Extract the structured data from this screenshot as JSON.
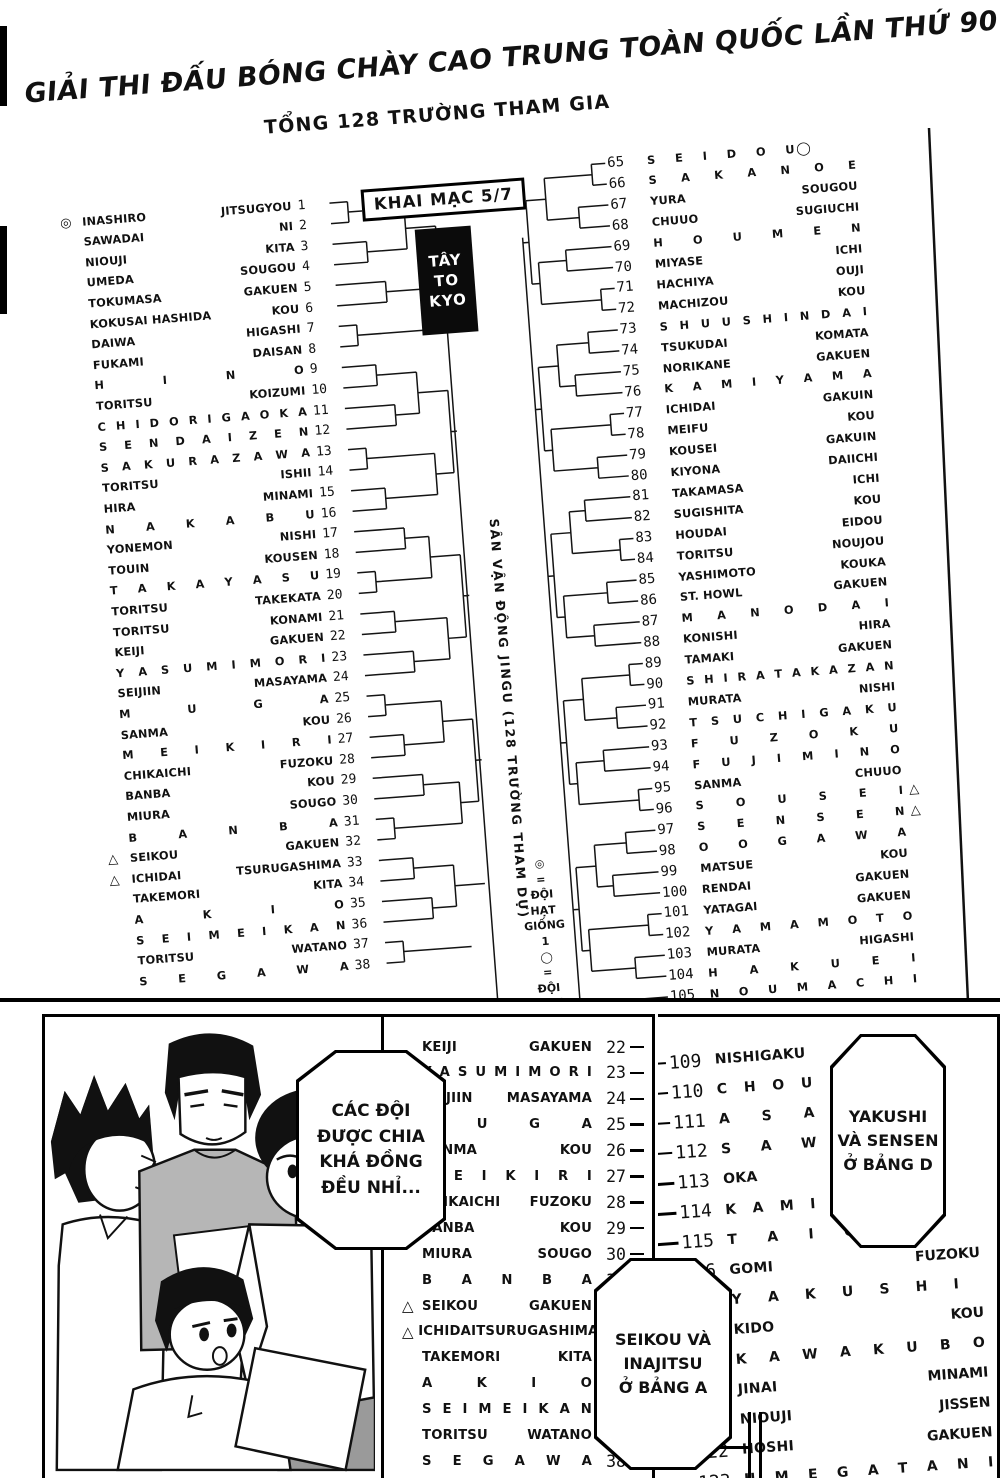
{
  "header": {
    "title_line1": "GIẢI THI ĐẤU BÓNG CHÀY CAO TRUNG TOÀN QUỐC LẦN THỨ 90",
    "title_line2": "TỔNG 128 TRƯỜNG THAM GIA",
    "opening_label": "KHAI MẠC 5/7",
    "region_box_lines": [
      "TÂY",
      "TO",
      "KYO"
    ]
  },
  "center": {
    "venue_vertical_text": "SÂN VẬN ĐỘNG JINGU (128 TRƯỜNG THAM DỰ)",
    "seed_legend_stack": [
      "◎",
      "=",
      "ĐỘI",
      "HẠT",
      "GIỐNG",
      "1",
      "◯",
      "=",
      "ĐỘI",
      "HẠT"
    ]
  },
  "bracket": {
    "left_rows": [
      {
        "n": 1,
        "a": "INASHIRO",
        "b": "JITSUGYOU",
        "m": "◎"
      },
      {
        "n": 2,
        "a": "SAWADAI",
        "b": "NI"
      },
      {
        "n": 3,
        "a": "NIOUJI",
        "b": "KITA"
      },
      {
        "n": 4,
        "a": "UMEDA",
        "b": "SOUGOU"
      },
      {
        "n": 5,
        "a": "TOKUMASA",
        "b": "GAKUEN"
      },
      {
        "n": 6,
        "a": "KOKUSAI HASHIDA",
        "b": "KOU"
      },
      {
        "n": 7,
        "a": "DAIWA",
        "b": "HIGASHI"
      },
      {
        "n": 8,
        "a": "FUKAMI",
        "b": "DAISAN"
      },
      {
        "n": 9,
        "s": "H I N O"
      },
      {
        "n": 10,
        "a": "TORITSU",
        "b": "KOIZUMI"
      },
      {
        "n": 11,
        "s": "C H I D O R I G A O K A"
      },
      {
        "n": 12,
        "s": "S E N D A I Z E N"
      },
      {
        "n": 13,
        "s": "S A K U R A Z A W A"
      },
      {
        "n": 14,
        "a": "TORITSU",
        "b": "ISHII"
      },
      {
        "n": 15,
        "a": "HIRA",
        "b": "MINAMI"
      },
      {
        "n": 16,
        "s": "N A K A B U"
      },
      {
        "n": 17,
        "a": "YONEMON",
        "b": "NISHI"
      },
      {
        "n": 18,
        "a": "TOUIN",
        "b": "KOUSEN"
      },
      {
        "n": 19,
        "s": "T A K A Y A S U"
      },
      {
        "n": 20,
        "a": "TORITSU",
        "b": "TAKEKATA"
      },
      {
        "n": 21,
        "a": "TORITSU",
        "b": "KONAMI"
      },
      {
        "n": 22,
        "a": "KEIJI",
        "b": "GAKUEN"
      },
      {
        "n": 23,
        "s": "Y A S U M I M O R I"
      },
      {
        "n": 24,
        "a": "SEIJIIN",
        "b": "MASAYAMA"
      },
      {
        "n": 25,
        "s": "M U G A"
      },
      {
        "n": 26,
        "a": "SANMA",
        "b": "KOU"
      },
      {
        "n": 27,
        "s": "M E I K I R I"
      },
      {
        "n": 28,
        "a": "CHIKAICHI",
        "b": "FUZOKU"
      },
      {
        "n": 29,
        "a": "BANBA",
        "b": "KOU"
      },
      {
        "n": 30,
        "a": "MIURA",
        "b": "SOUGO"
      },
      {
        "n": 31,
        "s": "B A N B A"
      },
      {
        "n": 32,
        "a": "SEIKOU",
        "b": "GAKUEN",
        "m": "△"
      },
      {
        "n": 33,
        "a": "ICHIDAI",
        "b": "TSURUGASHIMA",
        "m": "△"
      },
      {
        "n": 34,
        "a": "TAKEMORI",
        "b": "KITA"
      },
      {
        "n": 35,
        "s": "A K I O"
      },
      {
        "n": 36,
        "s": "S E I M E I K A N"
      },
      {
        "n": 37,
        "a": "TORITSU",
        "b": "WATANO"
      },
      {
        "n": 38,
        "s": "S E G A W A"
      }
    ],
    "right_rows": [
      {
        "n": 65,
        "s": "S E I D O U",
        "m": "◯"
      },
      {
        "n": 66,
        "s": "S A K A N O E"
      },
      {
        "n": 67,
        "a": "YURA",
        "b": "SOUGOU"
      },
      {
        "n": 68,
        "a": "CHUUO",
        "b": "SUGIUCHI"
      },
      {
        "n": 69,
        "s": "H O U M E N"
      },
      {
        "n": 70,
        "a": "MIYASE",
        "b": "ICHI"
      },
      {
        "n": 71,
        "a": "HACHIYA",
        "b": "OUJI"
      },
      {
        "n": 72,
        "a": "MACHIZOU",
        "b": "KOU"
      },
      {
        "n": 73,
        "s": "S H U U S H I N D A I"
      },
      {
        "n": 74,
        "a": "TSUKUDAI",
        "b": "KOMATA"
      },
      {
        "n": 75,
        "a": "NORIKANE",
        "b": "GAKUEN"
      },
      {
        "n": 76,
        "s": "K A M I Y A M A"
      },
      {
        "n": 77,
        "a": "ICHIDAI",
        "b": "GAKUIN"
      },
      {
        "n": 78,
        "a": "MEIFU",
        "b": "KOU"
      },
      {
        "n": 79,
        "a": "KOUSEI",
        "b": "GAKUIN"
      },
      {
        "n": 80,
        "a": "KIYONA",
        "b": "DAIICHI"
      },
      {
        "n": 81,
        "a": "TAKAMASA",
        "b": "ICHI"
      },
      {
        "n": 82,
        "a": "SUGISHITA",
        "b": "KOU"
      },
      {
        "n": 83,
        "a": "HOUDAI",
        "b": "EIDOU"
      },
      {
        "n": 84,
        "a": "TORITSU",
        "b": "NOUJOU"
      },
      {
        "n": 85,
        "a": "YASHIMOTO",
        "b": "KOUKA"
      },
      {
        "n": 86,
        "a": "ST. HOWL",
        "b": "GAKUEN"
      },
      {
        "n": 87,
        "s": "M A N O D A I"
      },
      {
        "n": 88,
        "a": "KONISHI",
        "b": "HIRA"
      },
      {
        "n": 89,
        "a": "TAMAKI",
        "b": "GAKUEN"
      },
      {
        "n": 90,
        "s": "S H I R A T A K A Z A N"
      },
      {
        "n": 91,
        "a": "MURATA",
        "b": "NISHI"
      },
      {
        "n": 92,
        "s": "T S U C H I G A K U"
      },
      {
        "n": 93,
        "s": "F U Z O K U"
      },
      {
        "n": 94,
        "s": "F U J I M I N O"
      },
      {
        "n": 95,
        "a": "SANMA",
        "b": "CHUUO"
      },
      {
        "n": 96,
        "s": "S O U S E I",
        "m": "△"
      },
      {
        "n": 97,
        "s": "S E N S E N",
        "m": "△"
      },
      {
        "n": 98,
        "s": "O O G A W A"
      },
      {
        "n": 99,
        "a": "MATSUE",
        "b": "KOU"
      },
      {
        "n": 100,
        "a": "RENDAI",
        "b": "GAKUEN"
      },
      {
        "n": 101,
        "a": "YATAGAI",
        "b": "GAKUEN"
      },
      {
        "n": 102,
        "s": "Y A M A M O T O"
      },
      {
        "n": 103,
        "a": "MURATA",
        "b": "HIGASHI"
      },
      {
        "n": 104,
        "s": "H A K U E I"
      },
      {
        "n": 105,
        "s": "N O U M A C H I"
      }
    ]
  },
  "bottom": {
    "bubble1_lines": [
      "CÁC ĐỘI",
      "ĐƯỢC CHIA",
      "KHÁ ĐỒNG",
      "ĐỀU NHỈ..."
    ],
    "bubble2_lines": [
      "YAKUSHI",
      "VÀ SENSEN",
      "Ở BẢNG D"
    ],
    "bubble3_lines": [
      "SEIKOU VÀ",
      "INAJITSU",
      "Ở BẢNG A"
    ],
    "mid_rows": [
      {
        "n": 22,
        "a": "KEIJI",
        "b": "GAKUEN"
      },
      {
        "n": 23,
        "s": "Y A S U M I M O R I"
      },
      {
        "n": 24,
        "a": "SEIJIIN",
        "b": "MASAYAMA"
      },
      {
        "n": 25,
        "s": "M U G A"
      },
      {
        "n": 26,
        "a": "SANMA",
        "b": "KOU"
      },
      {
        "n": 27,
        "s": "M E I K I R I"
      },
      {
        "n": 28,
        "a": "CHIKAICHI",
        "b": "FUZOKU"
      },
      {
        "n": 29,
        "a": "BANBA",
        "b": "KOU"
      },
      {
        "n": 30,
        "a": "MIURA",
        "b": "SOUGO"
      },
      {
        "n": 31,
        "s": "B A N B A"
      },
      {
        "n": 32,
        "a": "SEIKOU",
        "b": "GAKUEN",
        "m": "△"
      },
      {
        "n": 33,
        "a": "ICHIDAI",
        "b": "TSURUGASHIMA",
        "m": "△"
      },
      {
        "n": 34,
        "a": "TAKEMORI",
        "b": "KITA"
      },
      {
        "n": 35,
        "s": "A K I O"
      },
      {
        "n": 36,
        "s": "S E I M E I K A N"
      },
      {
        "n": 37,
        "a": "TORITSU",
        "b": "WATANO"
      },
      {
        "n": 38,
        "s": "S E G A W A"
      }
    ],
    "right_panel_rows": [
      {
        "n": 109,
        "a": "NISHIGAKU"
      },
      {
        "n": 110,
        "s": "C H O U"
      },
      {
        "n": 111,
        "s": "A S A"
      },
      {
        "n": 112,
        "s": "S A W"
      },
      {
        "n": 113,
        "a": "OKA"
      },
      {
        "n": 114,
        "s": "K A M I K"
      },
      {
        "n": 115,
        "s": "T A I G A"
      },
      {
        "n": 116,
        "a": "GOMI",
        "b": "FUZOKU"
      },
      {
        "n": 117,
        "s": "Y A K U S H I"
      },
      {
        "n": 118,
        "a": "KIDO",
        "b": "KOU"
      },
      {
        "n": 119,
        "s": "K A W A K U B O"
      },
      {
        "n": 120,
        "a": "JINAI",
        "b": "MINAMI"
      },
      {
        "n": 121,
        "a": "NIOUJI",
        "b": "JISSEN"
      },
      {
        "n": 122,
        "a": "HOSHI",
        "b": "GAKUEN"
      },
      {
        "n": 123,
        "s": "U M E G A T A N I"
      }
    ]
  },
  "colors": {
    "ink": "#111111",
    "paper": "#ffffff",
    "shirt_gray": "#b6b6b6",
    "shorts_gray": "#9a9a9a",
    "region_box_bg": "#0b0b0b"
  }
}
